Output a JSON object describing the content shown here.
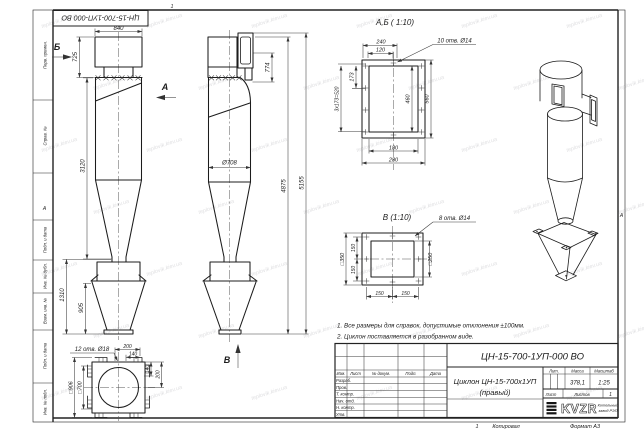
{
  "watermark": "teplovik.kiev.ua",
  "frame": {
    "margin_labels": [
      "Перв. примен.",
      "Справ. №",
      "Подп. и дата",
      "Инв. № дубл.",
      "Взам. инв. №",
      "Подп. и дата",
      "Инв. № подл."
    ],
    "zone_letter": "А",
    "zone_top": "1",
    "copy_number": "1"
  },
  "stamp_top": {
    "designation": "ЦН-15-700-1УП-000 ВО"
  },
  "views": {
    "left": {
      "label": "Б",
      "dim_840": "840",
      "dim_725": "725",
      "dim_3120": "3120",
      "dim_1310": "1310",
      "dim_905": "905"
    },
    "center": {
      "label_a": "А",
      "label_v": "В",
      "dim_d708": "Ø708",
      "dim_774": "774",
      "dim_4875": "4875",
      "dim_5155": "5155"
    },
    "detail_ab": {
      "title": "А,Б ( 1:10)",
      "callout": "10 отв. Ø14",
      "dim_240": "240",
      "dim_120": "120",
      "dim_173": "173",
      "dim_520": "3x173=520",
      "dim_460": "460",
      "dim_560": "560",
      "dim_180": "180",
      "dim_280": "280"
    },
    "detail_v": {
      "title": "В (1:10)",
      "callout": "8 отв. Ø14",
      "dim_sq350": "□350",
      "dim_sq250": "□250",
      "dim_150a": "150",
      "dim_150b": "150",
      "dim_150c": "150",
      "dim_150d": "150"
    },
    "detail_bottom": {
      "callout": "12 отв. Ø18",
      "dim_200t": "200",
      "dim_140t": "140",
      "dim_140r": "140",
      "dim_200r": "200",
      "dim_sq906": "□906",
      "dim_sq700": "□700"
    }
  },
  "notes": {
    "line1": "1. Все размеры для справок, допустимые отклонения ±100мм.",
    "line2": "2. Циклон поставляется в разобранном виде."
  },
  "title_block": {
    "designation": "ЦН-15-700-1УП-000 ВО",
    "doc_name_line1": "Циклон ЦН-15-700х1УП",
    "doc_name_line2": "(правый)",
    "col_izm": "Изм.",
    "col_list": "Лист",
    "col_doc": "№ докум.",
    "col_podp": "Подп.",
    "col_data": "Дата",
    "row_razrab": "Разраб.",
    "row_prov": "Пров.",
    "row_tkontr": "Т. контр.",
    "row_nachotd": "Нач. отд.",
    "row_nkontr": "Н. контр.",
    "row_utv": "Утв.",
    "lit_label": "Лит.",
    "mass_label": "Масса",
    "scale_label": "Масштаб",
    "mass_value": "378,1",
    "scale_value": "1:25",
    "list_label": "Лист",
    "listov_label": "Листов",
    "listov_value": "1",
    "logo_text": "KVZR",
    "company_line1": "Котельный",
    "company_line2": "завод РЭП",
    "copied_label": "Копировал",
    "format_label": "Формат А3"
  }
}
